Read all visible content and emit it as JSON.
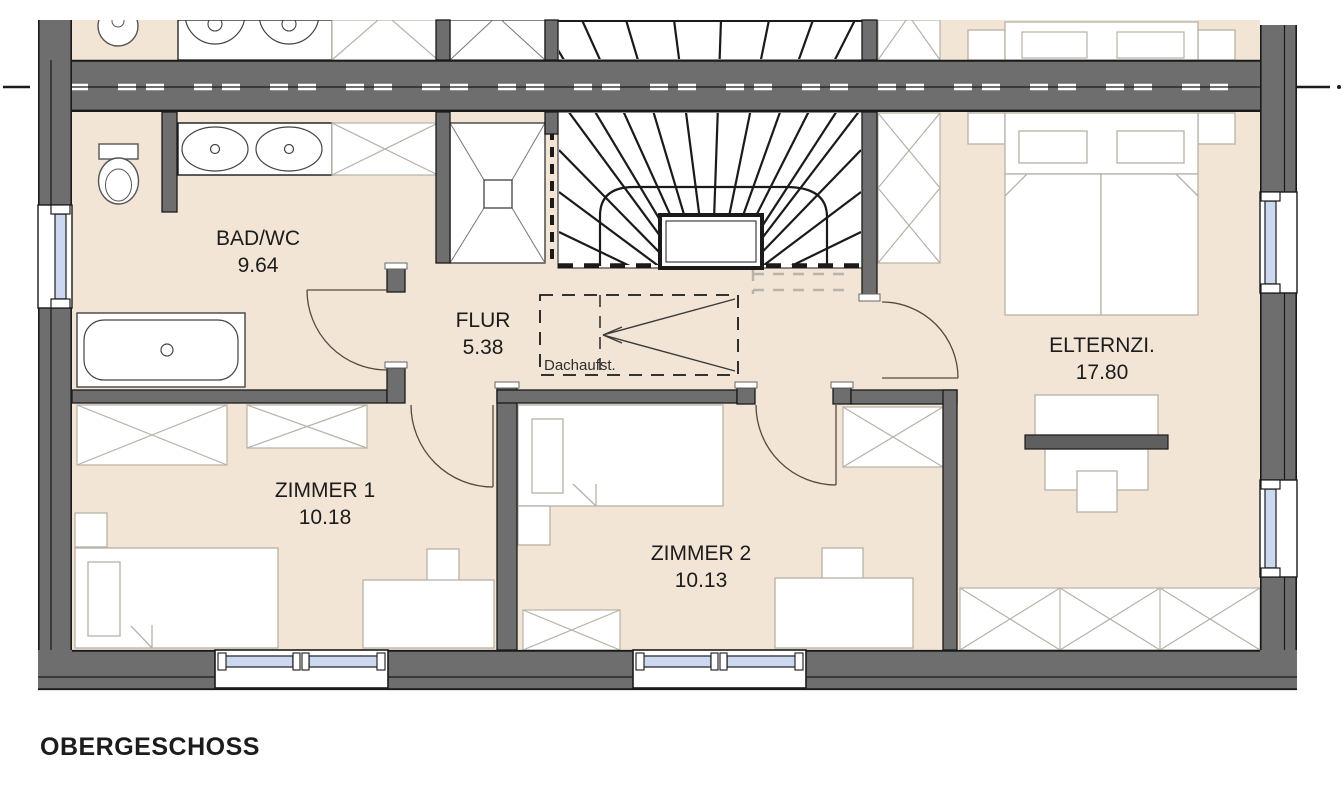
{
  "title": "OBERGESCHOSS",
  "rooms": [
    {
      "name": "BAD/WC",
      "area": "9.64"
    },
    {
      "name": "FLUR",
      "area": "5.38"
    },
    {
      "name": "ZIMMER 1",
      "area": "10.18"
    },
    {
      "name": "ZIMMER 2",
      "area": "10.13"
    },
    {
      "name": "ELTERNZI.",
      "area": "17.80"
    }
  ],
  "annotations": {
    "roof_access": "Dachaufst."
  },
  "colors": {
    "wall_gray": "#6e6e6e",
    "floor_beige": "#f2e5d5",
    "line_black": "#1a1a1a",
    "window_glass": "#ccd8f0",
    "furniture_outline": "#b7b1a7",
    "desk_bar_gray": "#5f5f5f"
  }
}
